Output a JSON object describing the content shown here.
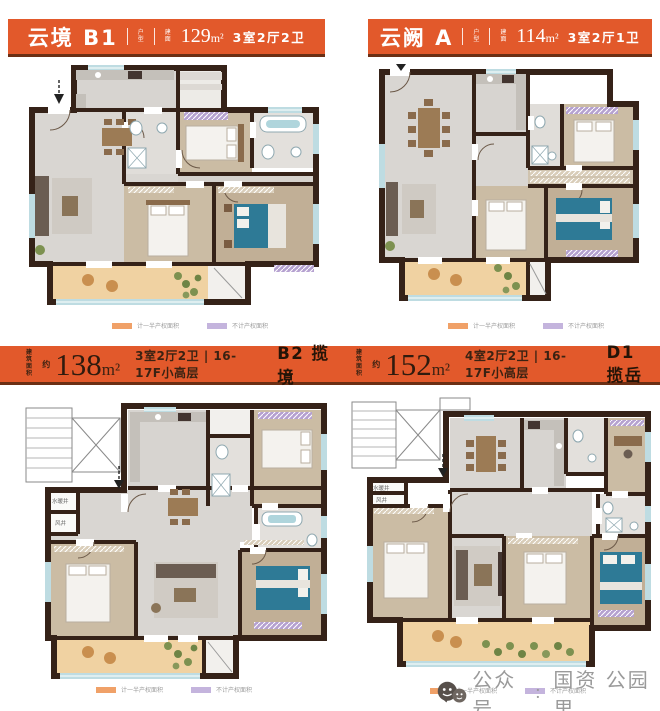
{
  "poster": {
    "headers": [
      {
        "title": "云境 B1",
        "divider_label": "户型",
        "area_prefix": "建面",
        "area_num": "129",
        "area_unit": "m²",
        "rooms": "3室2厅2卫"
      },
      {
        "title": "云阙 A",
        "divider_label": "户型",
        "area_prefix": "建面",
        "area_num": "114",
        "area_unit": "m²",
        "rooms": "3室2厅1卫"
      }
    ],
    "bands": [
      {
        "area_prefix": "建筑面积",
        "approx": "约",
        "area_num": "138",
        "area_unit": "m²",
        "specs": "3室2厅2卫 | 16-17F小高层",
        "model": "B2 揽境"
      },
      {
        "area_prefix": "建筑面积",
        "approx": "约",
        "area_num": "152",
        "area_unit": "m²",
        "specs": "4室2厅2卫 | 16-17F小高层",
        "model": "D1 揽岳"
      }
    ],
    "legend": {
      "half": "计一半产权面积",
      "none": "不计产权面积"
    },
    "shafts": {
      "water": "水暖井",
      "air": "风井"
    },
    "footer": {
      "channel": "公众号",
      "colon": "：",
      "account": "国资 公园里"
    },
    "colors": {
      "orange": "#E2592B",
      "legend_orange": "#F0A168",
      "legend_purple": "#C4B4DD",
      "footer_grey": "#9A9A9A"
    }
  }
}
